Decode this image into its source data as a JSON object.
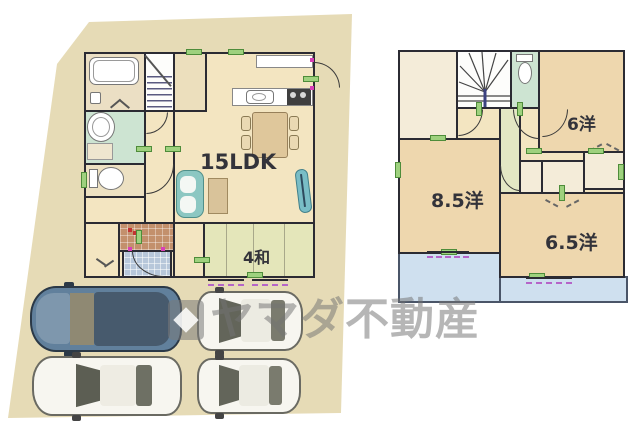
{
  "watermark": {
    "logo": "yamada-mark",
    "text": "ヤマダ不動産",
    "color": "#787878"
  },
  "floor1": {
    "ldk_label": "15LDK",
    "tatami_label": "4和"
  },
  "floor2": {
    "room6_label": "6洋",
    "room85_label": "8.5洋",
    "room65_label": "6.5洋"
  },
  "colors": {
    "site": "#e6dbb6",
    "floor": "#f3e5c1",
    "room_peach": "#eed7ae",
    "room_pale": "#f4ecd9",
    "mint": "#cde4d2",
    "tatami": "#e4e6ba",
    "balcony": "#cfe0ef",
    "wall": "#2b2b33",
    "marker_green": "#9ed17e",
    "marker_purple": "#b565c8",
    "genkan_tile": "#c3906c",
    "porch_tile": "#b7c7da",
    "car_dark": "#61809c",
    "car_white": "#f7f6f0"
  }
}
